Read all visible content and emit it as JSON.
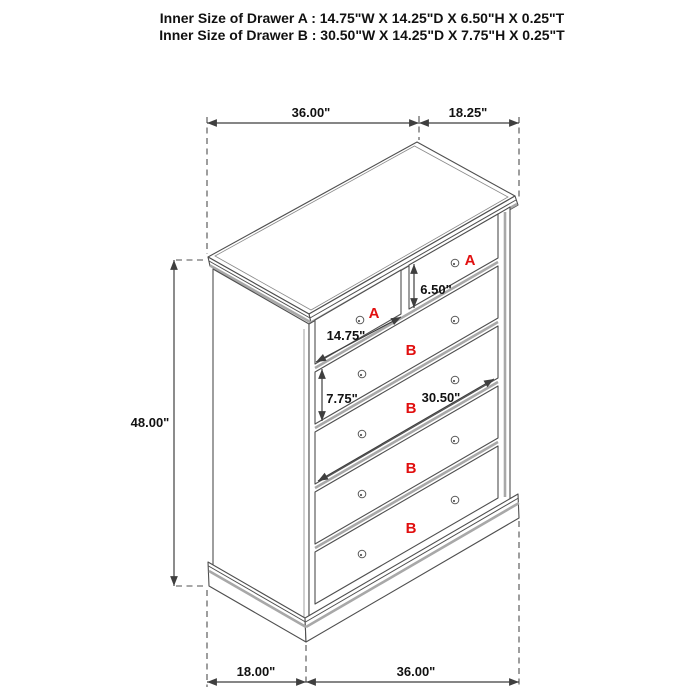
{
  "header": {
    "drawer_a": "Inner Size of Drawer A : 14.75\"W X 14.25\"D X 6.50\"H X 0.25\"T",
    "drawer_b": "Inner Size of Drawer B : 30.50\"W X 14.25\"D X 7.75\"H X 0.25\"T"
  },
  "dimensions": {
    "top_width": "36.00\"",
    "top_depth": "18.25\"",
    "overall_height": "48.00\"",
    "drawer_a_inner_width": "14.75\"",
    "drawer_a_inner_height": "6.50\"",
    "drawer_b_inner_height": "7.75\"",
    "drawer_b_inner_width": "30.50\"",
    "base_depth": "18.00\"",
    "base_width": "36.00\""
  },
  "drawer_labels": {
    "a": "A",
    "b": "B"
  },
  "colors": {
    "label_red": "#e10f0f",
    "line_dark": "#4f4f4f",
    "line_gray": "#a8a8a8",
    "text": "#111111",
    "background": "#ffffff"
  }
}
